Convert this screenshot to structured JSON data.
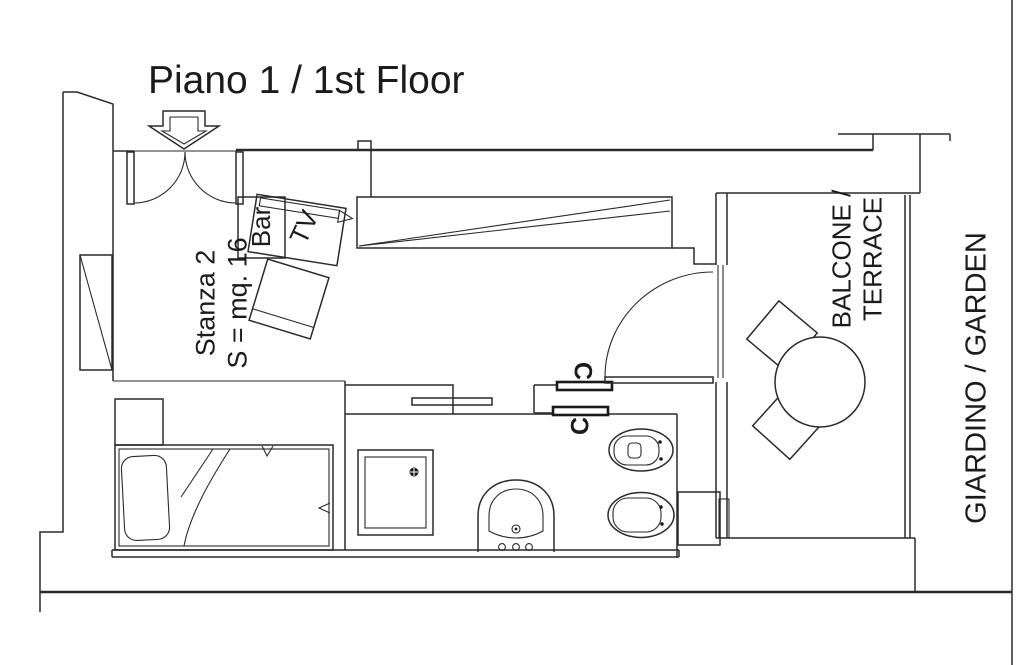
{
  "title": "Piano 1 / 1st Floor",
  "room": {
    "name": "Stanza 2",
    "area": "S = mq. 16"
  },
  "labels": {
    "bar": "Bar",
    "tv": "TV",
    "closet_top": "C",
    "closet_bottom": "C",
    "balcony": "BALCONE /\nTERRACE",
    "garden": "GIARDINO / GARDEN"
  },
  "colors": {
    "line": "#2a2a2a",
    "background": "#ffffff"
  }
}
